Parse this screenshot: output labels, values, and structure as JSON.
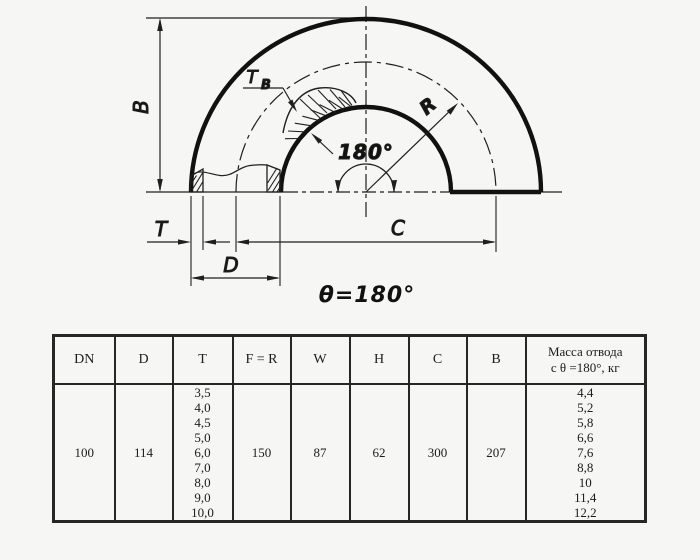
{
  "diagram": {
    "labels": {
      "b": "B",
      "tb_main": "T",
      "tb_sub": "B",
      "angle": "180°",
      "r": "R",
      "t": "T",
      "d": "D",
      "c": "C",
      "theta": "θ=180°"
    }
  },
  "table": {
    "headers": [
      "DN",
      "D",
      "T",
      "F = R",
      "W",
      "H",
      "C",
      "B",
      "Масса отвода\nс θ =180°, кг"
    ],
    "row": {
      "dn": "100",
      "d": "114",
      "t": "3,5\n4,0\n4,5\n5,0\n6,0\n7,0\n8,0\n9,0\n10,0",
      "f_r": "150",
      "w": "87",
      "h": "62",
      "c": "300",
      "b": "207",
      "mass": "4,4\n5,2\n5,8\n6,6\n7,6\n8,8\n10\n11,4\n12,2"
    }
  }
}
